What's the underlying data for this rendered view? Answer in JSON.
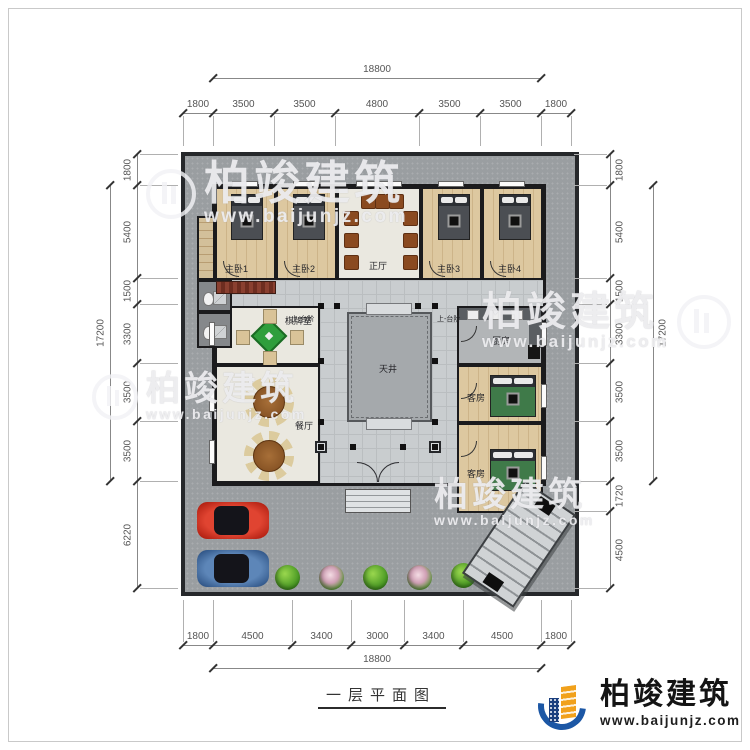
{
  "drawing": {
    "title": "一层平面图"
  },
  "branding": {
    "name": "柏竣建筑",
    "url": "www.baijunjz.com"
  },
  "rooms": {
    "master1": "主卧1",
    "master2": "主卧2",
    "hall": "正厅",
    "master3": "主卧3",
    "master4": "主卧4",
    "mahjong": "棋牌室",
    "dining": "餐厅",
    "kitchen": "厨房",
    "courtyard": "天井",
    "guest1": "客房",
    "guest2": "客房",
    "steps_left": "上-台阶",
    "steps_right": "上-台阶"
  },
  "dimensions": {
    "top": {
      "overall": "18800",
      "segments": [
        "1800",
        "3500",
        "3500",
        "4800",
        "3500",
        "3500",
        "1800"
      ]
    },
    "bottom": {
      "overall": "18800",
      "segments": [
        "1800",
        "4500",
        "3400",
        "3000",
        "3400",
        "4500",
        "1800"
      ]
    },
    "left": {
      "overall": "17200",
      "segments": [
        "1800",
        "5400",
        "1500",
        "3300",
        "3500",
        "3500",
        "6220"
      ]
    },
    "right": {
      "overall": "17200",
      "segments": [
        "1800",
        "5400",
        "1500",
        "3300",
        "3500",
        "3500",
        "1720",
        "4500"
      ]
    }
  },
  "colors": {
    "accent_blue": "#1c57a5",
    "accent_orange": "#f1a11c",
    "wall": "#1b1b1d",
    "ground": "#9a9ea1",
    "wood_floor": "#ddc8a0",
    "car_red": "#c0301c",
    "car_blue": "#41699e",
    "plant_green": "#55a22a",
    "mahjong_green": "#2f9e3c"
  }
}
